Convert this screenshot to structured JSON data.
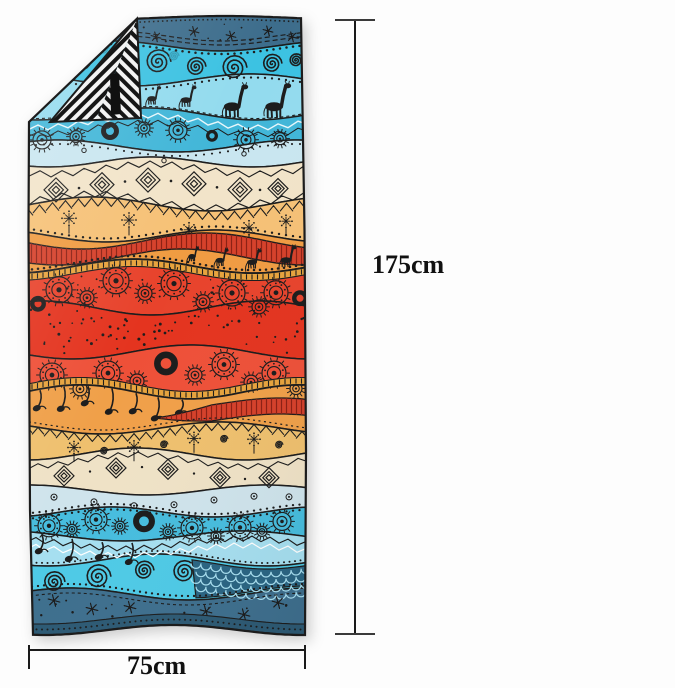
{
  "background_color": "#fdfdfd",
  "product": {
    "type": "beach towel",
    "style": "bohemian tribal wave pattern with giraffes, mandalas, spirals and folded corner showing black-white geometric reverse side"
  },
  "dimensions": {
    "height": {
      "label": "175cm"
    },
    "width": {
      "label": "75cm"
    },
    "line_color": "#1a1a1a",
    "label_color": "#111111"
  },
  "towel": {
    "outline_color": "#1c1c1c",
    "fold": {
      "black": "#161616",
      "white": "#f3f3f3",
      "tag": "#101010"
    },
    "accents": {
      "gold": "#e7a33d",
      "red_stripe": "#d6402a",
      "stripe_line": "#8c2013",
      "scale_bg": "#2a6583",
      "scale_arc": "#a8dff0",
      "dark_strip": "#2d5a74",
      "spiral_alt": "#2e9ab5",
      "zigzag_light": "#e8f7fb"
    },
    "boundaries": [
      [
        8,
        2,
        0.3,
        1.0
      ],
      [
        36,
        5,
        2.2,
        1.3
      ],
      [
        70,
        6,
        5.0,
        1.2
      ],
      [
        104,
        6,
        1.2,
        1.3
      ],
      [
        136,
        6,
        3.8,
        1.2
      ],
      [
        152,
        5,
        0.8,
        1.4
      ],
      [
        194,
        7,
        2.9,
        1.2
      ],
      [
        226,
        6,
        5.5,
        1.3
      ],
      [
        256,
        7,
        1.8,
        1.2
      ],
      [
        298,
        7,
        4.2,
        1.3
      ],
      [
        342,
        7,
        0.3,
        1.2
      ],
      [
        382,
        7,
        3.1,
        1.3
      ],
      [
        418,
        6,
        5.8,
        1.2
      ],
      [
        444,
        6,
        1.5,
        1.3
      ],
      [
        480,
        5,
        4.6,
        1.2
      ],
      [
        502,
        5,
        2.0,
        1.4
      ],
      [
        526,
        5,
        5.2,
        1.2
      ],
      [
        550,
        6,
        0.9,
        1.3
      ],
      [
        584,
        6,
        3.5,
        1.2
      ],
      [
        620,
        5,
        1.1,
        1.1
      ]
    ],
    "bands": [
      {
        "name": "dark-blue-stars",
        "color": "#3d6d8c",
        "motifs": [
          "stars",
          "dots",
          "dash-lines"
        ]
      },
      {
        "name": "turquoise-spirals",
        "color": "#3cc2e2",
        "motifs": [
          "spirals"
        ]
      },
      {
        "name": "sky-giraffes",
        "color": "#93dbee",
        "motifs": [
          "giraffes",
          "dot-border"
        ]
      },
      {
        "name": "teal-mandalas",
        "color": "#41b6d8",
        "motifs": [
          "zigzag",
          "mandalas"
        ]
      },
      {
        "name": "pale-blue",
        "color": "#c9e6f0",
        "motifs": [
          "dots"
        ]
      },
      {
        "name": "cream-diamonds",
        "color": "#f2e4c9",
        "motifs": [
          "diamonds",
          "zigzag-edges"
        ]
      },
      {
        "name": "peach-dandelions",
        "color": "#f6c176",
        "motifs": [
          "triangle-row",
          "dandelions"
        ]
      },
      {
        "name": "orange-red-wave",
        "color": "#f09c42",
        "motifs": [
          "red-stripe-wave",
          "giraffes"
        ]
      },
      {
        "name": "red-mandalas-upper",
        "color": "#e8432c",
        "motifs": [
          "gold-trim",
          "mandalas"
        ]
      },
      {
        "name": "red-dotted",
        "color": "#e4341f",
        "motifs": [
          "dot-scatter"
        ]
      },
      {
        "name": "red-mandalas-lower",
        "color": "#ee5038",
        "motifs": [
          "mandalas",
          "gold-trim"
        ]
      },
      {
        "name": "orange-notes",
        "color": "#f0a049",
        "motifs": [
          "hanging-notes",
          "red-stripe-wave"
        ]
      },
      {
        "name": "golden-zigzag",
        "color": "#efc06e",
        "motifs": [
          "triangle-row",
          "dandelions",
          "curls"
        ]
      },
      {
        "name": "cream-diamonds-2",
        "color": "#efe2c6",
        "motifs": [
          "diamonds",
          "zigzag"
        ]
      },
      {
        "name": "pale-blue-rings",
        "color": "#cfe4ec",
        "motifs": [
          "rings",
          "dot-border"
        ]
      },
      {
        "name": "teal-mandalas-2",
        "color": "#47bdde",
        "motifs": [
          "mandalas"
        ]
      },
      {
        "name": "sky-triangles",
        "color": "#a6dff0",
        "motifs": [
          "zigzag",
          "hanging-notes"
        ]
      },
      {
        "name": "turquoise-spirals-2",
        "color": "#4ecae6",
        "motifs": [
          "spirals",
          "scale-patch"
        ]
      },
      {
        "name": "dark-blue-stars-2",
        "color": "#3e6f8e",
        "motifs": [
          "stars",
          "dots",
          "dark-strip"
        ]
      }
    ]
  }
}
